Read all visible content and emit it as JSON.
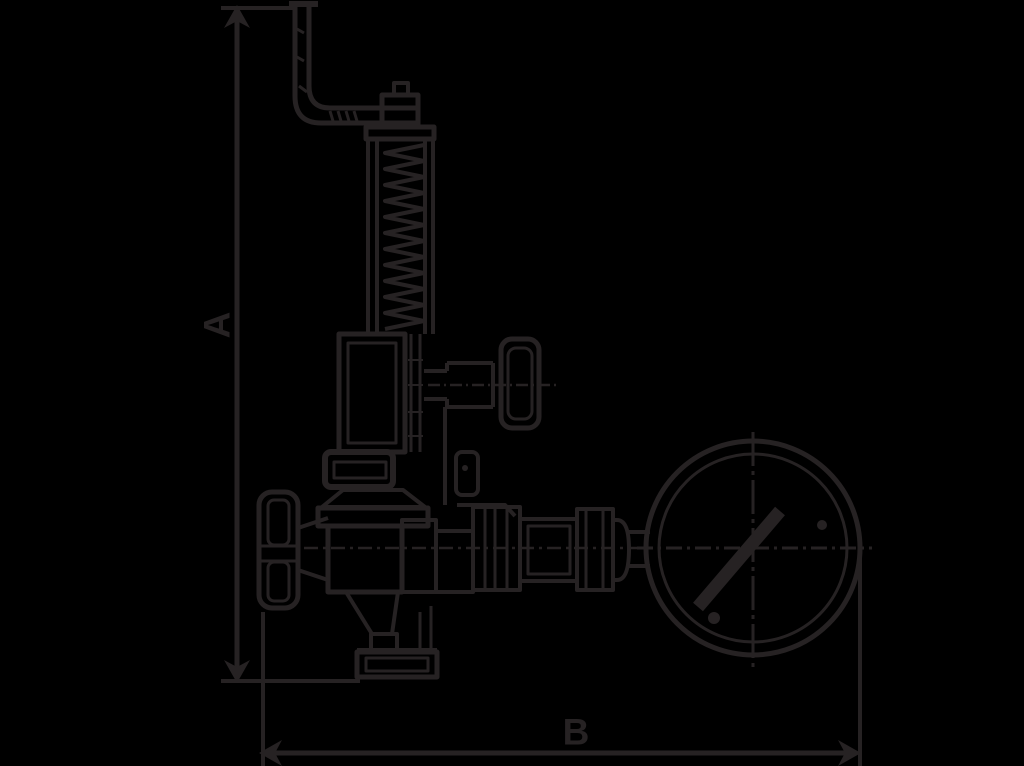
{
  "canvas": {
    "background_color": "#000000",
    "line_color": "#262223",
    "width": 1024,
    "height": 766
  },
  "dimension_labels": {
    "a": "A",
    "b": "B"
  }
}
